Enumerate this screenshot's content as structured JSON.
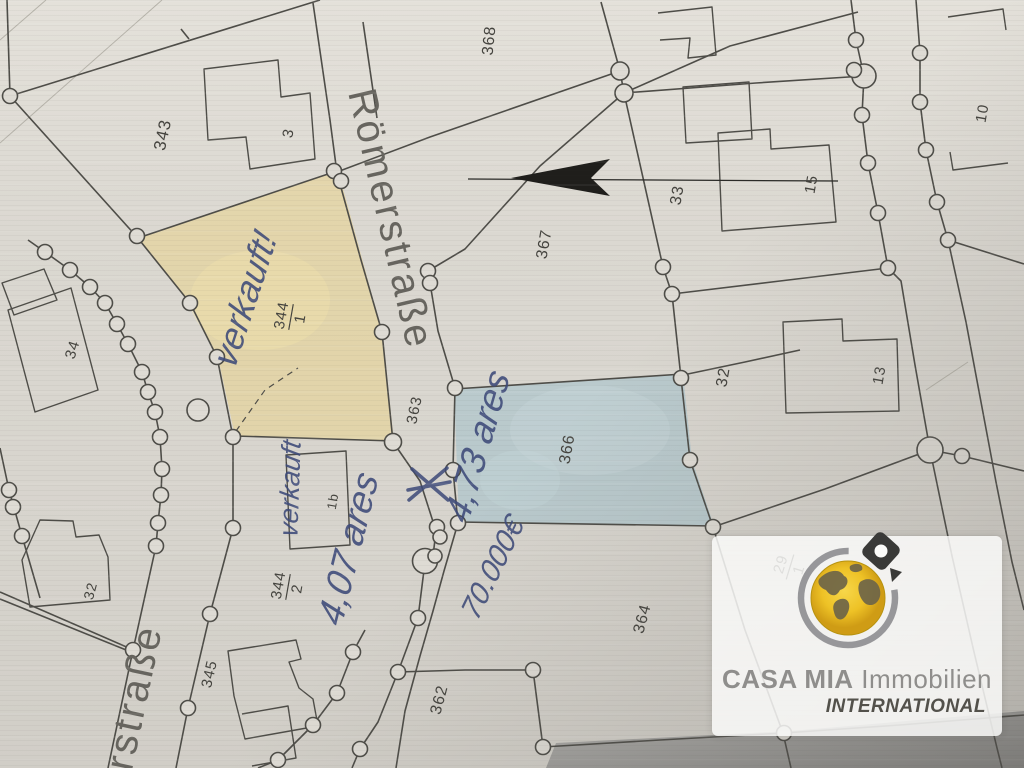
{
  "map": {
    "street_names": {
      "roemerstrasse": "Römerstraße",
      "partial_strasse": "rstraße"
    },
    "parcel_numbers": {
      "p343": "343",
      "p3": "3",
      "p368": "368",
      "p367": "367",
      "p33": "33",
      "p15": "15",
      "p10": "10",
      "p32_right": "32",
      "p13": "13",
      "p366": "366",
      "p363": "363",
      "p364": "364",
      "p362": "362",
      "p34": "34",
      "p32_left": "32",
      "p345": "345",
      "p1b": "1b"
    },
    "parcel_fractions": {
      "f344_1": {
        "num": "344",
        "den": "1"
      },
      "f344_2": {
        "num": "344",
        "den": "2"
      },
      "f29_1": {
        "num": "29",
        "den": "1"
      }
    },
    "handwritten_notes": {
      "sold_main": "verkauft!",
      "sold_small": "verkauft",
      "area_344_2": "4,07 ares",
      "area_366": "4,73 ares",
      "price": "70.000€"
    }
  },
  "logo": {
    "brand": "CASA MIA",
    "brand_suffix": " Immobilien",
    "subtitle": "INTERNATIONAL"
  },
  "colors": {
    "highlight_sold_yellow": "#e9d48d",
    "highlight_offer_blue": "#adc5cc",
    "handwriting_ink": "#3d4a79",
    "map_line": "#4e4d48",
    "north_arrow": "#1f1e1b",
    "logo_text_gray": "#8f8e8c",
    "logo_subtitle_gray": "#53514b",
    "globe_yellow": "#f0c42a"
  }
}
